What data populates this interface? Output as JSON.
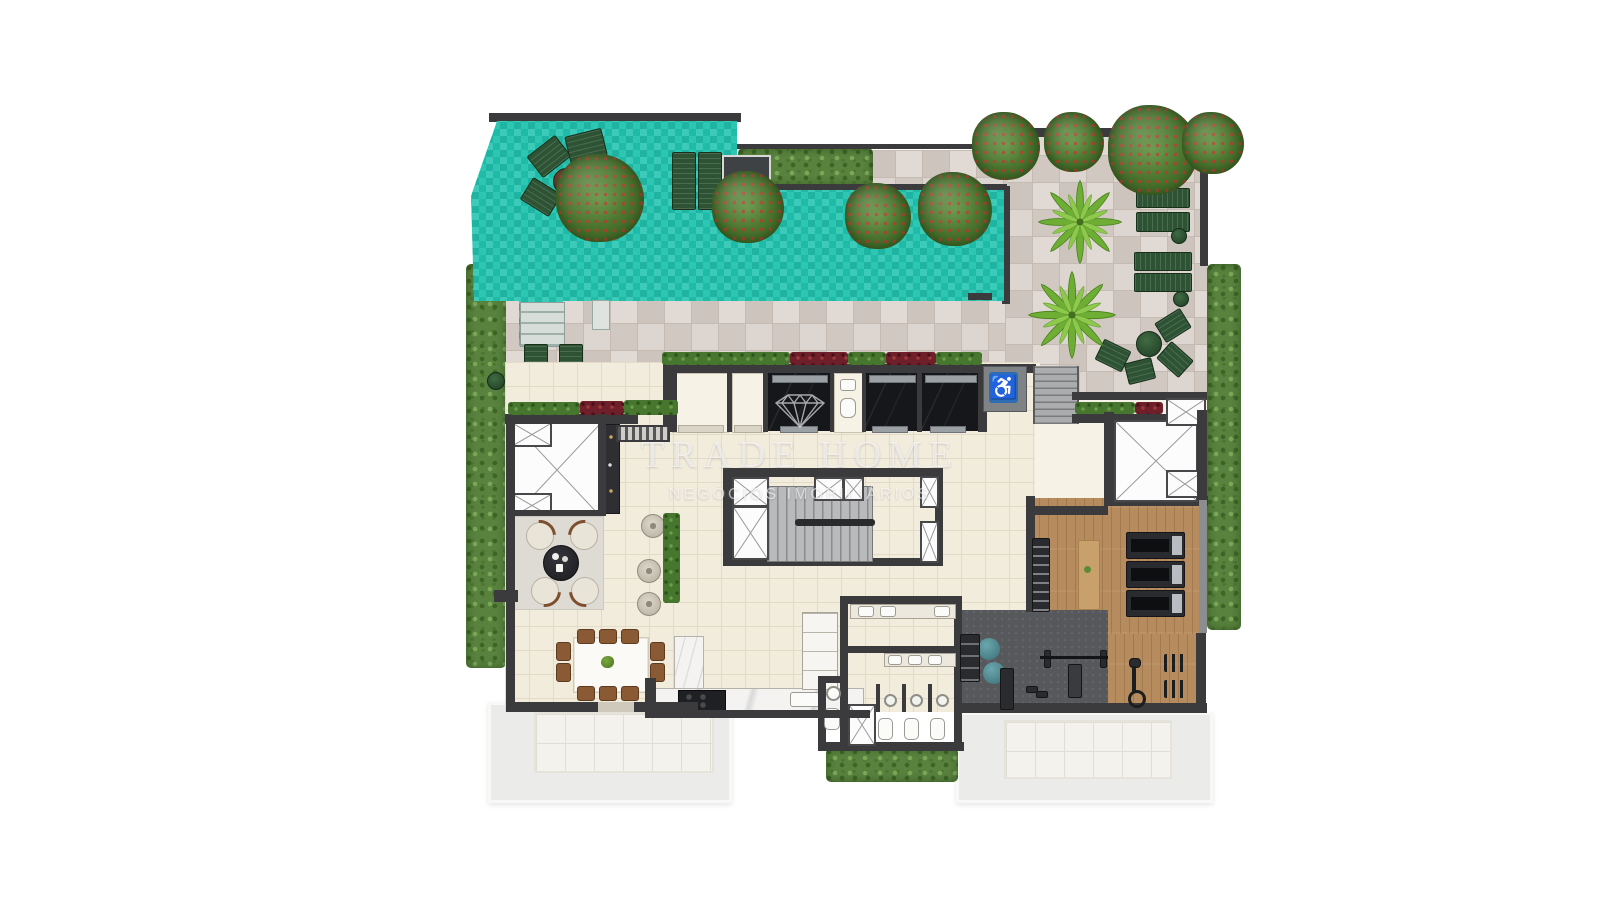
{
  "watermark": {
    "brand": "TRADE HOME",
    "tagline": "NEGÓCIOS IMOBILIÁRIOS",
    "logo_icon": "diamond-icon"
  },
  "signage": {
    "accessibility_icon": "wheelchair-icon",
    "accessibility_symbol": "♿"
  },
  "colors": {
    "pool_water": "#21c3af",
    "deck_pavers": "#d8cfc8",
    "interior_floor": "#f2ecdd",
    "walls": "#3b3b3d",
    "hedge_green": "#58823e",
    "gym_wood_floor": "#b68c5e",
    "gym_rubber_mat": "#57585c",
    "lower_roof_terrace": "#ebecea",
    "lounger_green": "#2d5334",
    "accessibility_blue": "#2e6db4",
    "watermark": "rgba(255,255,255,0.58)"
  },
  "zones": [
    "swimming-pool",
    "pool-deck",
    "garden-terrace",
    "palm-garden",
    "elevator-lobby",
    "stair-core",
    "lounge",
    "dining-room",
    "kitchen",
    "locker-rooms",
    "gym",
    "lower-roof-terrace"
  ]
}
